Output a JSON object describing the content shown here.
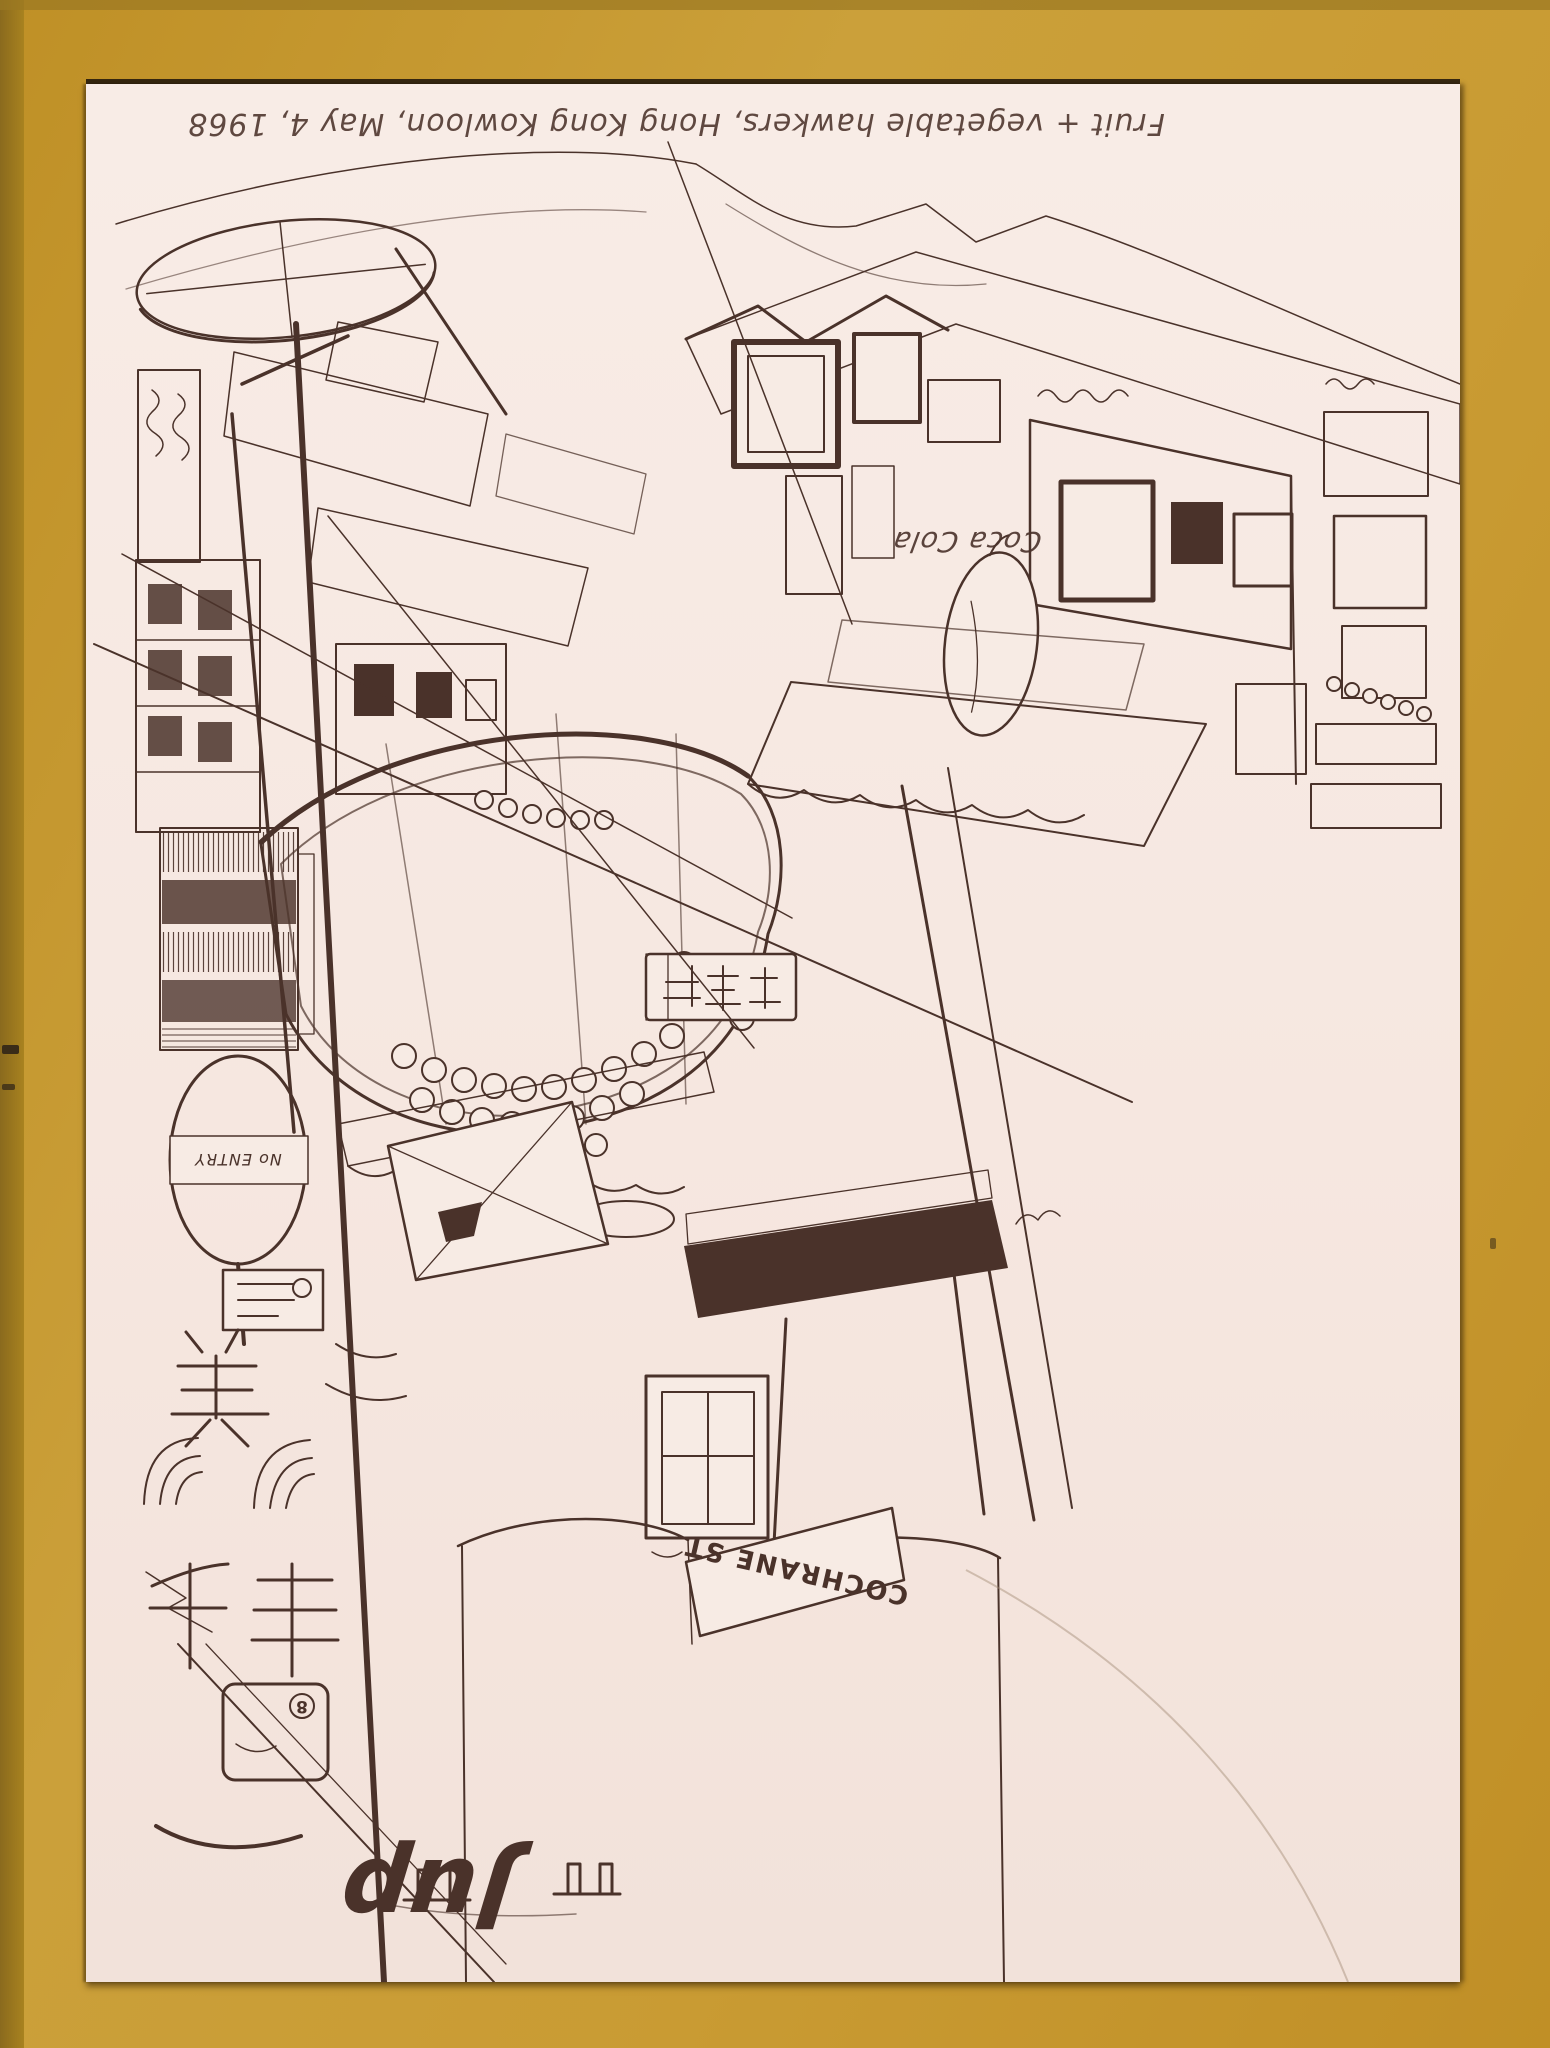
{
  "artwork": {
    "caption": "Fruit + vegetable hawkers, Hong Kong Kowloon, May 4, 1968",
    "signs": {
      "coca_cola": "Coca Cola",
      "street": "COCHRANE ST",
      "no_entry": "No ENTRY",
      "circled_number": "8",
      "monogram": "Jup",
      "cjk_box_label": "国",
      "cjk_char_mei": "美",
      "cjk_char_qian": "千",
      "cjk_char_feng": "丰",
      "cjk_shop_board": "老千飯"
    },
    "colors": {
      "mount_gold": "#C79A33",
      "paper_cream": "#F7EBE4",
      "ink_sepia": "#4A322A",
      "pencil_grey": "#A18A74"
    }
  }
}
